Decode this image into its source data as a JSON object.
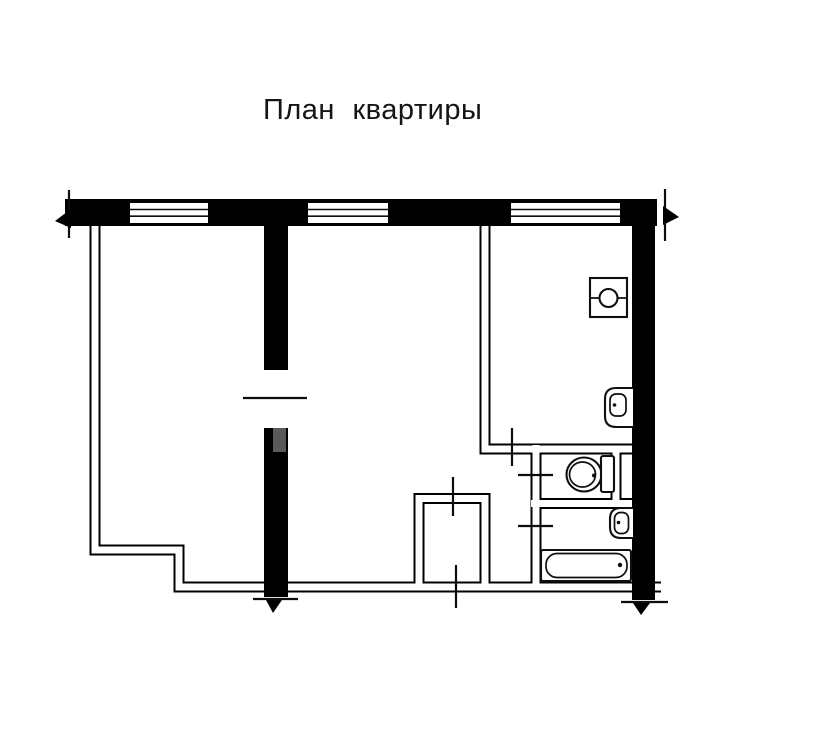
{
  "title": "План квартиры",
  "plan": {
    "windows_count": 3,
    "section_marks_count": 4,
    "fixtures": [
      {
        "icon": "stove-icon",
        "label": "stove"
      },
      {
        "icon": "kitchen-sink-icon",
        "label": "kitchen sink"
      },
      {
        "icon": "toilet-icon",
        "label": "toilet"
      },
      {
        "icon": "washbasin-icon",
        "label": "washbasin"
      },
      {
        "icon": "bathtub-icon",
        "label": "bathtub"
      }
    ],
    "colors": {
      "wall": "#000000",
      "line": "#0f0f0f",
      "watermark": "#6f6f6f",
      "background": "#ffffff"
    }
  }
}
